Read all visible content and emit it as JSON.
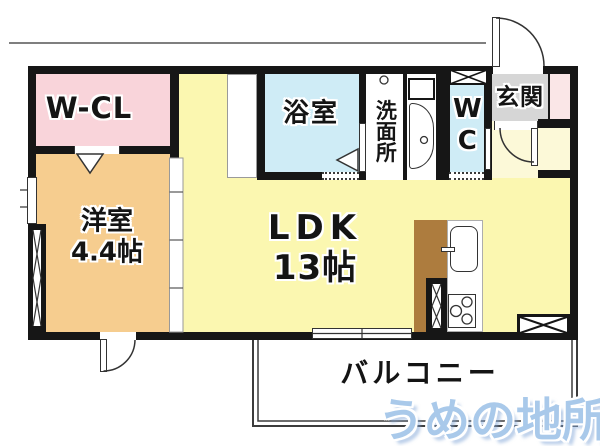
{
  "rooms": {
    "wcl": {
      "label": "W-CL"
    },
    "youshitsu": {
      "label": "洋室",
      "size": "4.4帖"
    },
    "bath": {
      "label": "浴室"
    },
    "senmensho": {
      "label": "洗面所"
    },
    "wc": {
      "label": "WC"
    },
    "genkan": {
      "label": "玄関"
    },
    "ldk": {
      "label": "LDK",
      "size": "13帖"
    },
    "balcony": {
      "label": "バルコニー"
    }
  },
  "watermark": {
    "label": "うめの地所"
  },
  "colors": {
    "wall": "#161616",
    "ldk_floor": "#fbf7b0",
    "hall_floor": "#fcf9d8",
    "youshitsu_floor": "#f6cd8f",
    "wcl_floor": "#f9d4da",
    "wet_area_floor": "#cfecf6",
    "genkan_tile": "#d6d6d6",
    "closet_pink": "#fae6e7",
    "kitchen_counter": "#ad7c3e",
    "watermark_blue": "#a9c9ea"
  },
  "fixtures": {
    "doors": [
      "entrance-swing-door",
      "hall-swing-door",
      "bedroom-exterior-swing-door",
      "bath-folding-door",
      "wcl-folding-door",
      "bedroom-sliding-partition",
      "balcony-sliding-window"
    ],
    "kitchen": [
      "counter",
      "sink",
      "faucet",
      "stove-3-burner"
    ],
    "sanitary": [
      "washbasin",
      "washing-machine-space"
    ]
  }
}
